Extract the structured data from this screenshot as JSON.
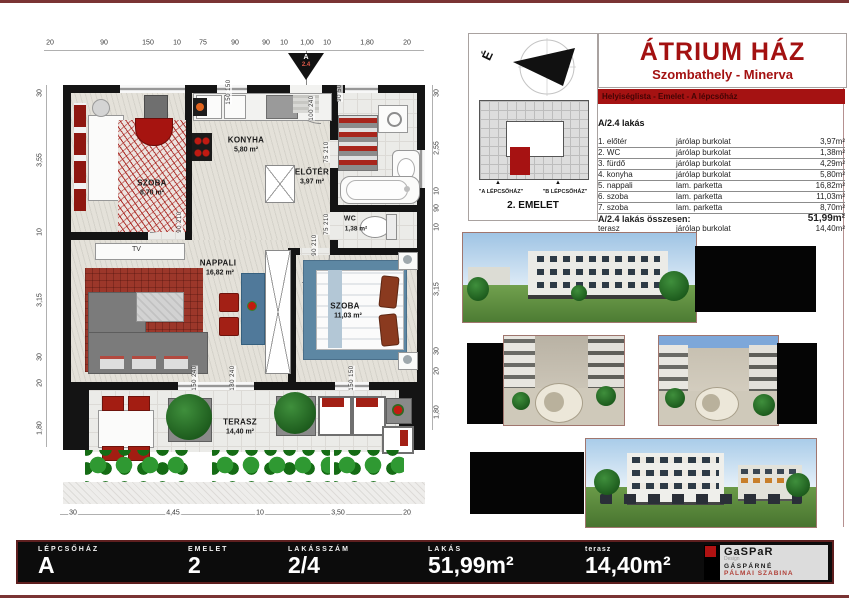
{
  "sheet": {
    "title": "ÁTRIUM HÁZ",
    "subtitle": "Szombathely - Minerva",
    "banner": "Helyiséglista - Emelet - A lépcsőház"
  },
  "keyplan": {
    "north": "É",
    "arrow": "▲",
    "stair_a": "\"A LÉPCSŐHÁZ\"",
    "stair_b": "\"B LÉPCSŐHÁZ\"",
    "floor": "2. EMELET"
  },
  "unit": {
    "heading": "A/2.4 lakás",
    "rows": [
      {
        "name": "1. előtér",
        "finish": "járólap burkolat",
        "area": "3,97m²"
      },
      {
        "name": "2. WC",
        "finish": "járólap burkolat",
        "area": "1,38m²"
      },
      {
        "name": "3. fürdő",
        "finish": "járólap burkolat",
        "area": "4,29m²"
      },
      {
        "name": "4. konyha",
        "finish": "járólap burkolat",
        "area": "5,80m²"
      },
      {
        "name": "5. nappali",
        "finish": "lam. parketta",
        "area": "16,82m²"
      },
      {
        "name": "6. szoba",
        "finish": "lam. parketta",
        "area": "11,03m²"
      },
      {
        "name": "7. szoba",
        "finish": "lam. parketta",
        "area": "8,70m²"
      }
    ],
    "total_label": "A/2.4  lakás összesen:",
    "total_area": "51,99m²",
    "terrace": {
      "name": "terasz",
      "finish": "járólap burkolat",
      "area": "14,40m²"
    }
  },
  "plan": {
    "marker_line1": "A",
    "marker_line2": "2.4",
    "tv": "TV",
    "rooms": {
      "szoba1": {
        "name": "SZOBA",
        "area": "8,70 m²"
      },
      "konyha": {
        "name": "KONYHA",
        "area": "5,80 m²"
      },
      "eloter": {
        "name": "ELŐTÉR",
        "area": "3,97 m²"
      },
      "wc": {
        "name": "WC",
        "area": "1,38 m²"
      },
      "nappali": {
        "name": "NAPPALI",
        "area": "16,82 m²"
      },
      "szoba2": {
        "name": "SZOBA",
        "area": "11,03 m²"
      },
      "terasz": {
        "name": "TERASZ",
        "area": "14,40 m²"
      }
    },
    "dims_top": [
      "20",
      "90",
      "150",
      "10",
      "75",
      "90",
      "90",
      "10",
      "1,00",
      "10",
      "1,80",
      "20"
    ],
    "dims_left": [
      "30",
      "3,55",
      "10",
      "3,15",
      "30",
      "20",
      "1,80"
    ],
    "dims_right": [
      "30",
      "2,55",
      "10",
      "90",
      "10",
      "3,15",
      "30",
      "20",
      "1,80"
    ],
    "dims_bottom": [
      "30",
      "4,45",
      "10",
      "3,50",
      "20"
    ],
    "openings": [
      {
        "w": "150",
        "h": "150"
      },
      {
        "w": "90",
        "h": "50"
      },
      {
        "w": "100",
        "h": "240"
      },
      {
        "w": "75",
        "h": "210"
      },
      {
        "w": "90",
        "h": "210"
      },
      {
        "w": "75",
        "h": "210"
      },
      {
        "w": "90",
        "h": "210"
      },
      {
        "w": "150",
        "h": "240"
      },
      {
        "w": "180",
        "h": "240"
      },
      {
        "w": "150",
        "h": "150"
      }
    ]
  },
  "footer": {
    "cells": [
      {
        "label": "LÉPCSŐHÁZ",
        "value": "A"
      },
      {
        "label": "EMELET",
        "value": "2"
      },
      {
        "label": "LAKÁSSZÁM",
        "value": "2/4"
      },
      {
        "label": "LAKÁS",
        "value": "51,99m²"
      },
      {
        "label": "terasz",
        "value": "14,40m²"
      }
    ],
    "logo": {
      "brand": "GaSPaR",
      "brand_sub": "Design",
      "line1": "GÁSPÁRNÉ",
      "line2": "PÁLMAI SZABINA"
    }
  },
  "colors": {
    "accent_red": "#a31111",
    "banner_bg": "#a51212",
    "footer_bg": "#0c0c0c"
  }
}
